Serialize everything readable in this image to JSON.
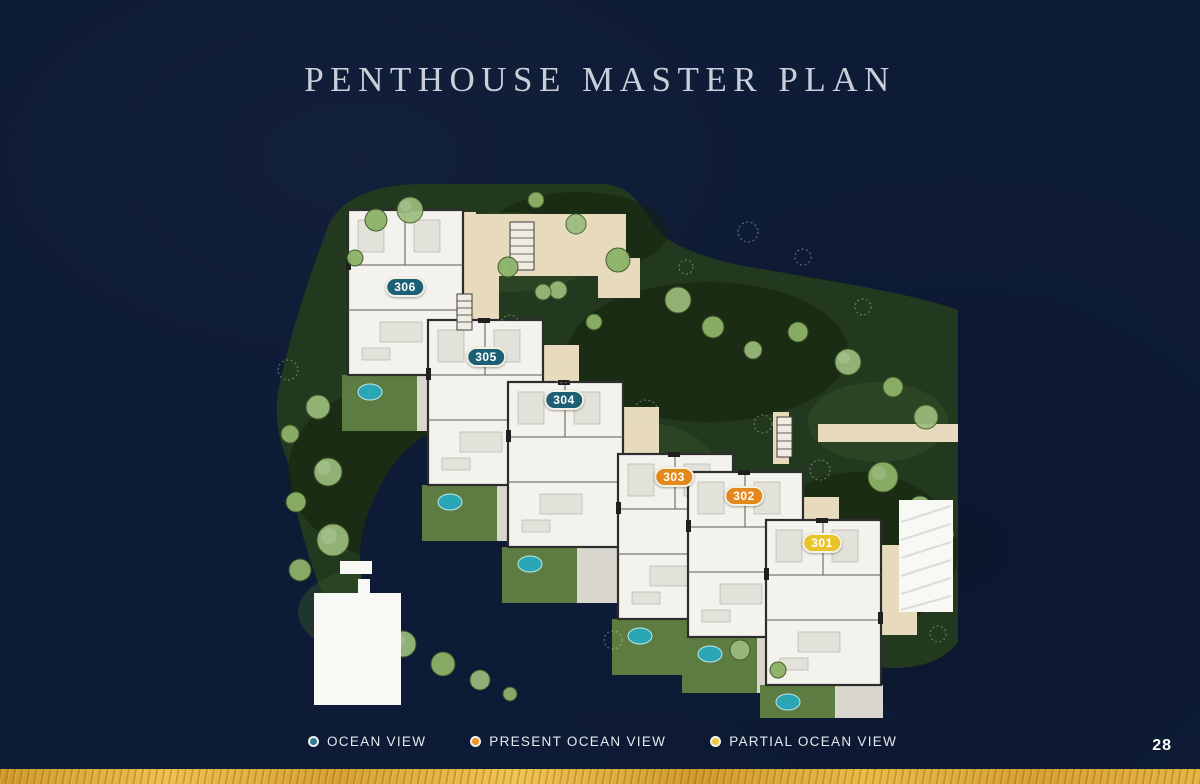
{
  "page": {
    "title": "PENTHOUSE MASTER PLAN",
    "page_number": "28",
    "background_color": "#0E1B36",
    "gold_bar_color": "#DDA935"
  },
  "legend": {
    "items": [
      {
        "label": "OCEAN VIEW",
        "color": "#2E7D96"
      },
      {
        "label": "PRESENT OCEAN VIEW",
        "color": "#F09122"
      },
      {
        "label": "PARTIAL OCEAN VIEW",
        "color": "#EEC83E"
      }
    ]
  },
  "site_plan": {
    "description": "Penthouse site plan with six units cascading from upper-left to lower-right",
    "units": [
      {
        "id": "306",
        "view": "ocean",
        "color": "#1D6075",
        "x": 405,
        "y": 287
      },
      {
        "id": "305",
        "view": "ocean",
        "color": "#1D6075",
        "x": 486,
        "y": 357
      },
      {
        "id": "304",
        "view": "ocean",
        "color": "#1D6075",
        "x": 564,
        "y": 400
      },
      {
        "id": "303",
        "view": "present-ocean",
        "color": "#E3891C",
        "x": 674,
        "y": 477
      },
      {
        "id": "302",
        "view": "present-ocean",
        "color": "#E3891C",
        "x": 744,
        "y": 496
      },
      {
        "id": "301",
        "view": "partial-ocean",
        "color": "#E9C32A",
        "x": 822,
        "y": 543
      }
    ]
  }
}
